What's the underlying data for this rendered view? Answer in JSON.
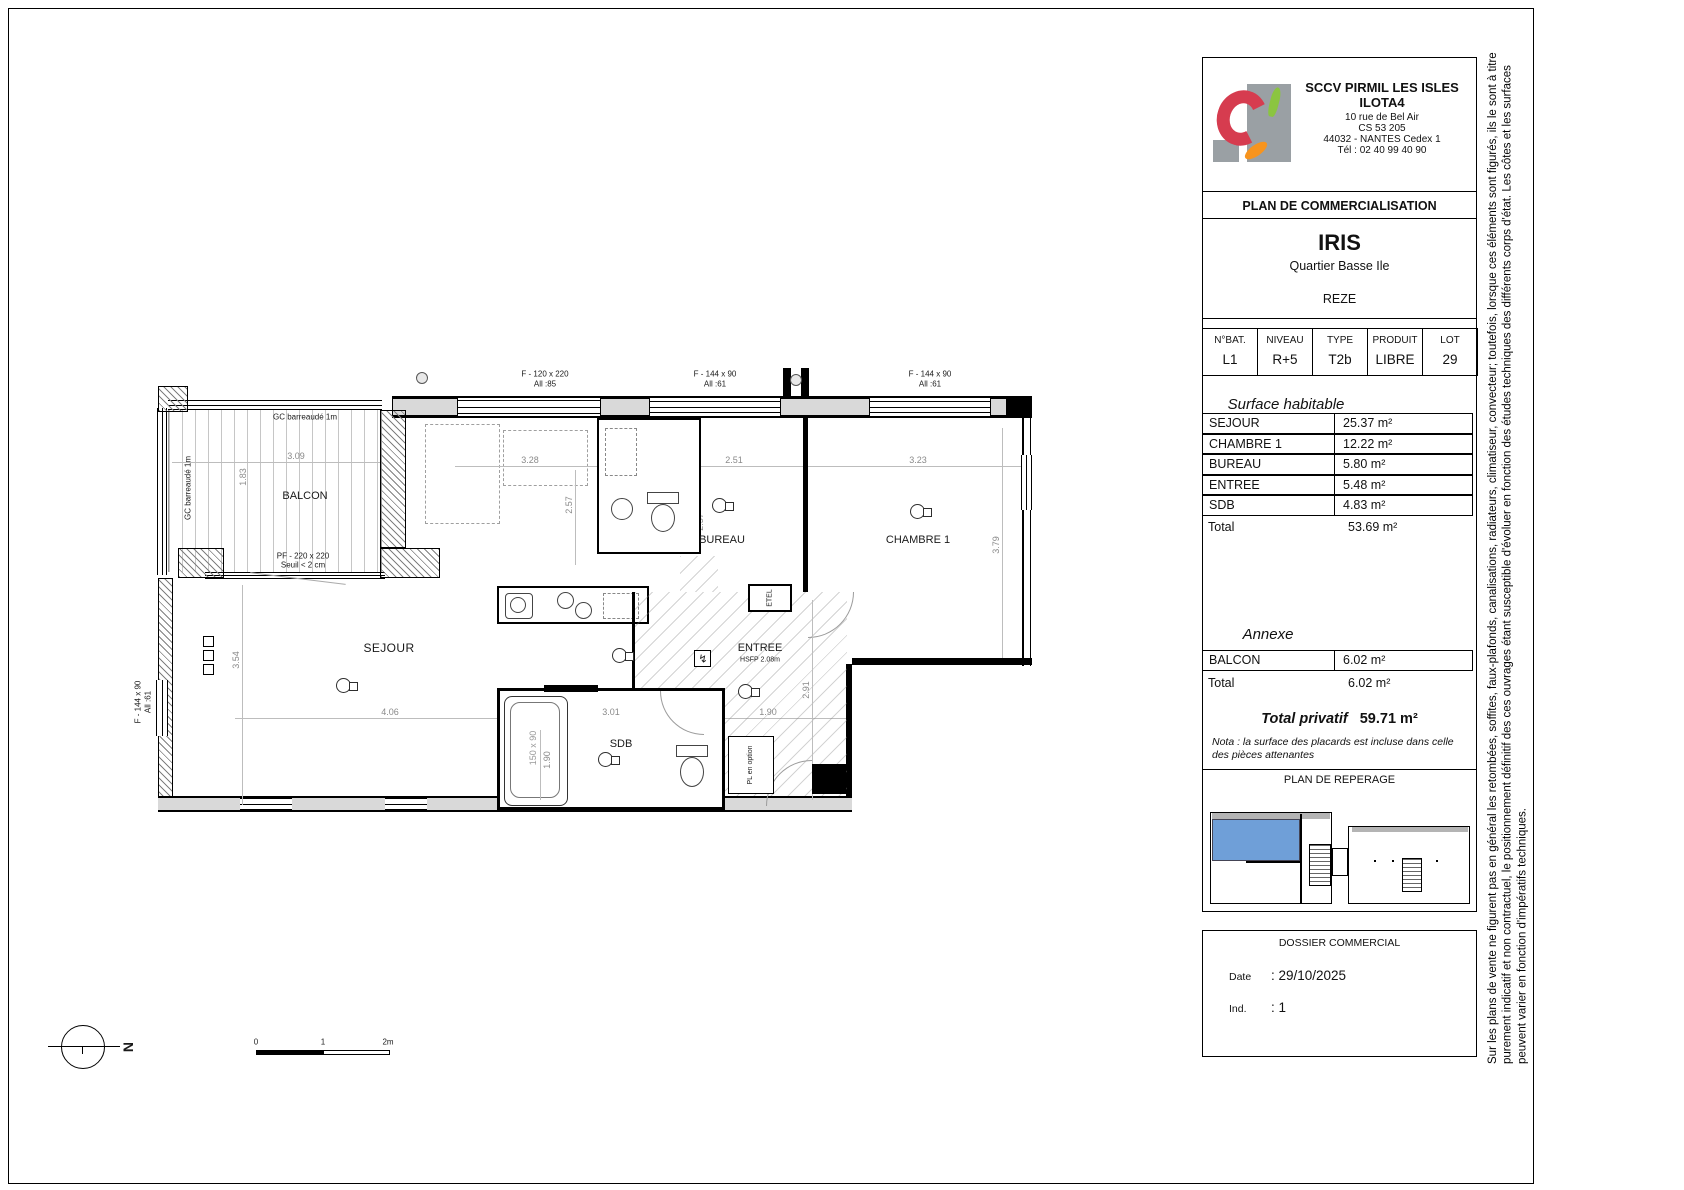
{
  "title_block": {
    "company": {
      "name_line1": "SCCV PIRMIL LES ISLES",
      "name_line2": "ILOTA4",
      "address1": "10 rue de Bel Air",
      "address2": "CS 53 205",
      "address3": "44032 - NANTES Cedex 1",
      "phone": "Tél : 02 40 99 40 90"
    },
    "plan_title": "PLAN DE COMMERCIALISATION",
    "program": {
      "name": "IRIS",
      "district": "Quartier Basse Ile",
      "city": "REZE"
    },
    "lot_table": {
      "headers": [
        "N°BAT.",
        "NIVEAU",
        "TYPE",
        "PRODUIT",
        "LOT"
      ],
      "values": [
        "L1",
        "R+5",
        "T2b",
        "LIBRE",
        "29"
      ]
    },
    "surface_habitable": {
      "title": "Surface habitable",
      "rows": [
        {
          "name": "SEJOUR",
          "value": "25.37 m²"
        },
        {
          "name": "CHAMBRE 1",
          "value": "12.22 m²"
        },
        {
          "name": "BUREAU",
          "value": "5.80 m²"
        },
        {
          "name": "ENTREE",
          "value": "5.48 m²"
        },
        {
          "name": "SDB",
          "value": "4.83 m²"
        }
      ],
      "total_label": "Total",
      "total_value": "53.69 m²"
    },
    "annexe": {
      "title": "Annexe",
      "rows": [
        {
          "name": "BALCON",
          "value": "6.02 m²"
        }
      ],
      "total_label": "Total",
      "total_value": "6.02 m²"
    },
    "total_privatif": {
      "label": "Total privatif",
      "value": "59.71 m²"
    },
    "nota": "Nota : la surface des placards est incluse dans celle des pièces attenantes",
    "reperage_title": "PLAN DE REPERAGE",
    "dossier": {
      "title": "DOSSIER COMMERCIAL",
      "date_label": "Date",
      "date_value": ": 29/10/2025",
      "ind_label": "Ind.",
      "ind_value": ": 1"
    }
  },
  "disclaimer": {
    "line1": "Sur les plans de vente ne figurent pas en général les retombées, soffites, faux-plafonds, canalisations, radiateurs, climatiseur, convecteur; toutefois, lorsque ces éléments sont figurés, ils le sont à titre",
    "line2": "purement indicatif et non contractuel, le positionnement définitif des ces ouvrages étant susceptible d'évoluer en fonction des études techniques des différents corps d'état. Les côtes et les surfaces",
    "line3": "peuvent varier en  fonction d'impératifs techniques."
  },
  "plan": {
    "windows": {
      "w1l1": "F -  120 x 220",
      "w1l2": "All :85",
      "w2l1": "F -  144 x 90",
      "w2l2": "All :61",
      "w3l1": "F -  144 x 90",
      "w3l2": "All :61",
      "wll1": "F -  144 x 90",
      "wll2": "All :61"
    },
    "rooms": {
      "balcon": "BALCON",
      "sejour": "SEJOUR",
      "bureau": "BUREAU",
      "chambre1": "CHAMBRE 1",
      "entree": "ENTREE",
      "entree_hsfp": "HSFP 2.08m",
      "sdb": "SDB"
    },
    "notes": {
      "gc_top": "GC barreaudé 1m",
      "gc_left": "GC barreaudé 1m",
      "pf1": "PF -  220 x 220",
      "pf2": "Seuil < 2 cm",
      "pl": "PL en option",
      "etel": "ETEL",
      "tub": "150 x 90",
      "elec": "↯"
    },
    "dims": {
      "d309": "3.09",
      "d183": "1.83",
      "d328": "3.28",
      "d354": "3.54",
      "d406": "4.06",
      "d251": "2.51",
      "d257a": "2.57",
      "d257b": "2.57",
      "d323": "3.23",
      "d379": "3.79",
      "d301": "3.01",
      "d190a": "1.90",
      "d190b": "1.90",
      "d291": "2.91"
    }
  },
  "scale_bar": {
    "t0": "0",
    "t1": "1",
    "t2": "2m"
  },
  "north_label": "N",
  "colors": {
    "highlight_blue": "#6f9fd8",
    "logo_red": "#d63c4f",
    "logo_gray": "#9aa0a4",
    "logo_green": "#8bc540",
    "logo_orange": "#f7941e"
  }
}
